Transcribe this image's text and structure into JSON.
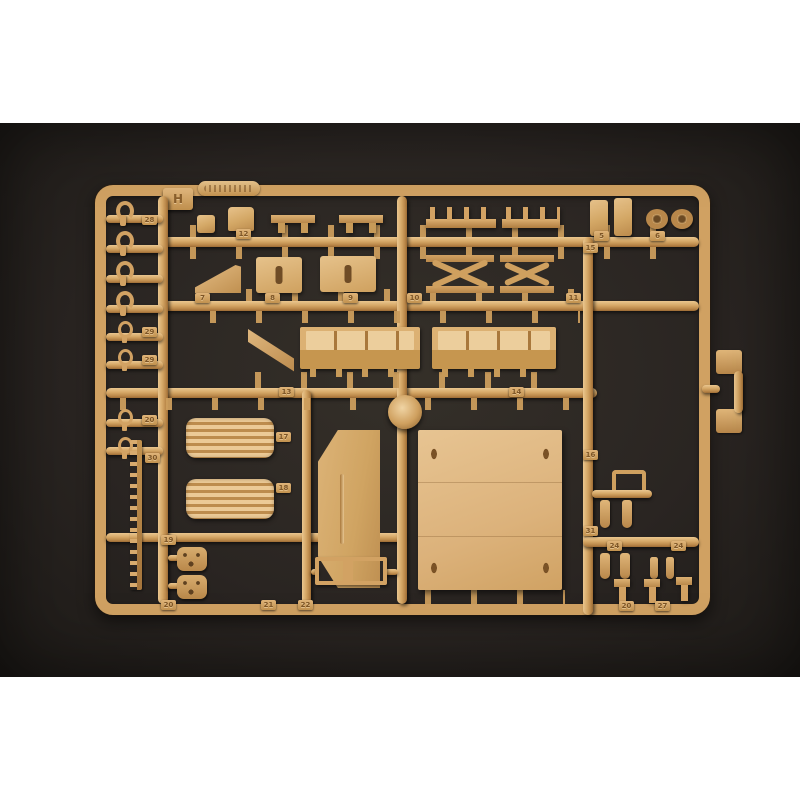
{
  "image": {
    "type": "photograph",
    "subject": "tan injection-molded plastic model kit sprue (parts tree) photographed on a dark background with white borders above and below",
    "sprue_letter": "H",
    "colors": {
      "plastic": "#d4a766",
      "plastic_highlight": "#ecca96",
      "plastic_shadow": "#9c6c35",
      "photo_background": "#2a2522",
      "page_background": "#ffffff"
    }
  },
  "tabs": [
    {
      "label": "H"
    },
    {
      "label": "28"
    },
    {
      "label": "29"
    },
    {
      "label": "29"
    },
    {
      "label": "20"
    },
    {
      "label": "30"
    },
    {
      "label": "12"
    },
    {
      "label": "5"
    },
    {
      "label": "6"
    },
    {
      "label": "7"
    },
    {
      "label": "8"
    },
    {
      "label": "9"
    },
    {
      "label": "10"
    },
    {
      "label": "15"
    },
    {
      "label": "11"
    },
    {
      "label": "13"
    },
    {
      "label": "14"
    },
    {
      "label": "17"
    },
    {
      "label": "18"
    },
    {
      "label": "16"
    },
    {
      "label": "19"
    },
    {
      "label": "20"
    },
    {
      "label": "21"
    },
    {
      "label": "22"
    },
    {
      "label": "31"
    },
    {
      "label": "24"
    },
    {
      "label": "24"
    },
    {
      "label": "20"
    },
    {
      "label": "27"
    }
  ],
  "parts_visible": [
    "sprue-frame",
    "embossed-brand-plate (text illegible)",
    "sprue-letter-tab-H",
    "tow-hooks (x4)",
    "shackle-rings (x4)",
    "ladder-strip",
    "wedge-block",
    "slotted-boxes (x2)",
    "scissor-frames (x2)",
    "pin-rails (x2)",
    "small-posts (x2)",
    "lifting-eyes (x2)",
    "side-panels-with-raised-hatches (x2)",
    "pennant-bracket",
    "louvered-panels (x2)",
    "bevel-edged-door-panel",
    "large-deck-panel",
    "perforated-brackets (x2)",
    "h-frame-bracket",
    "twin-foot-pad-part",
    "small-pegs-and-levers",
    "injection-gate-node"
  ]
}
